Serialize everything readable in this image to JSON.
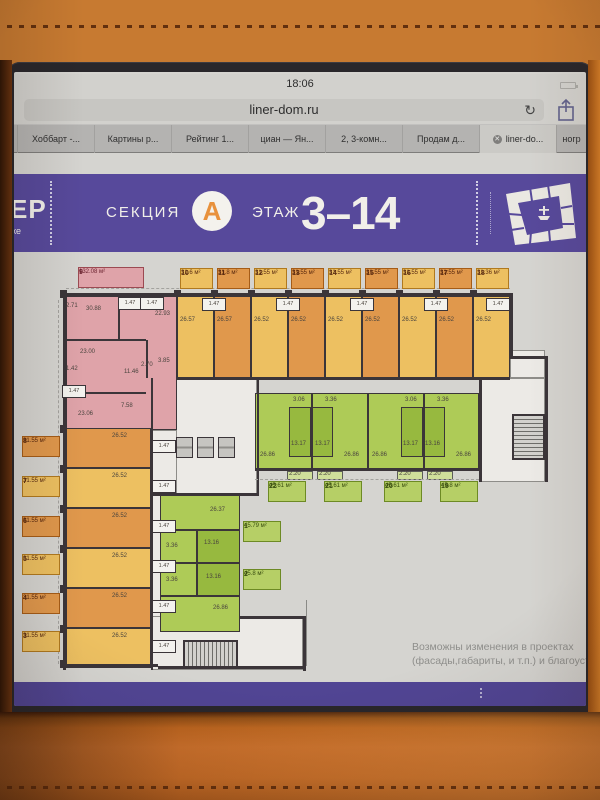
{
  "colors": {
    "screen_bg": "#d5d4d0",
    "bar_bg": "#d2d1cd",
    "field_bg": "#c7c6c2",
    "tabbar_bg": "#b4b3b1",
    "tab_active_bg": "#cbcac6",
    "purple": "#57499b",
    "purple_footer": "#514594",
    "accent_orange": "#e8913c",
    "plan_white": "#eceae6",
    "pink": "#dfa3a9",
    "yellow": "#edc061",
    "orange": "#e0984c",
    "green_light": "#aecb57",
    "green_dark": "#97b93f",
    "wall": "#3b3539"
  },
  "status_bar": {
    "time": "18:06"
  },
  "browser": {
    "url": "liner-dom.ru",
    "tabs": [
      "Хоббарт -...",
      "Картины р...",
      "Рейтинг 1...",
      "циан — Ян...",
      "2, 3-комн...",
      "Продам д...",
      "liner-do...",
      "ногр"
    ],
    "active_tab_index": 6
  },
  "header": {
    "logo_top": "ЕР",
    "logo_bottom": "ке",
    "section_label": "СЕКЦИЯ",
    "section_letter": "А",
    "floor_label": "ЭТАЖ",
    "floor_range": "3–14"
  },
  "plan": {
    "top_units": [
      {
        "id": "9",
        "area": "132.08 м²",
        "tone": "pink"
      },
      {
        "id": "10",
        "area": "31.6 м²",
        "tone": "yellow"
      },
      {
        "id": "11",
        "area": "31.8 м²",
        "tone": "orange"
      },
      {
        "id": "12",
        "area": "31.55 м²",
        "tone": "yellow"
      },
      {
        "id": "13",
        "area": "31.55 м²",
        "tone": "orange"
      },
      {
        "id": "14",
        "area": "31.55 м²",
        "tone": "yellow"
      },
      {
        "id": "15",
        "area": "31.55 м²",
        "tone": "orange"
      },
      {
        "id": "16",
        "area": "31.55 м²",
        "tone": "yellow"
      },
      {
        "id": "17",
        "area": "31.55 м²",
        "tone": "orange"
      },
      {
        "id": "18",
        "area": "31.36 м²",
        "tone": "yellow"
      }
    ],
    "left_units": [
      {
        "id": "8",
        "area": "31.55 м²",
        "tone": "orange"
      },
      {
        "id": "7",
        "area": "31.55 м²",
        "tone": "yellow"
      },
      {
        "id": "6",
        "area": "31.55 м²",
        "tone": "orange"
      },
      {
        "id": "5",
        "area": "31.55 м²",
        "tone": "yellow"
      },
      {
        "id": "4",
        "area": "31.55 м²",
        "tone": "orange"
      },
      {
        "id": "3",
        "area": "31.55 м²",
        "tone": "yellow"
      }
    ],
    "mid_units": [
      {
        "id": "22",
        "area": "45.61 м²",
        "tone": "green"
      },
      {
        "id": "21",
        "area": "45.61 м²",
        "tone": "green"
      },
      {
        "id": "20",
        "area": "45.61 м²",
        "tone": "green"
      },
      {
        "id": "19",
        "area": "45.8 м²",
        "tone": "green"
      }
    ],
    "low_units": [
      {
        "id": "1",
        "area": "45.79 м²",
        "tone": "green"
      },
      {
        "id": "2",
        "area": "45.8 м²",
        "tone": "green"
      }
    ],
    "room_values": [
      "30.88",
      "22.93",
      "23.00",
      "11.46",
      "23.06",
      "7.58",
      "2.71",
      "1.42",
      "2.70",
      "3.85",
      "26.57",
      "26.57",
      "26.52",
      "26.52",
      "26.52",
      "26.52",
      "26.52",
      "26.52",
      "26.52",
      "26.52",
      "26.52",
      "26.52",
      "26.52",
      "26.52",
      "26.52",
      "26.86",
      "13.17",
      "13.17",
      "26.86",
      "26.86",
      "13.17",
      "13.16",
      "26.86",
      "3.06",
      "3.36",
      "3.06",
      "3.36",
      "2.20",
      "2.20",
      "2.20",
      "2.20",
      "26.37",
      "13.16",
      "3.36",
      "13.16",
      "3.36",
      "26.86"
    ],
    "small_room_value": "1.47",
    "disclaimer_line1": "Возможны изменения в проектах",
    "disclaimer_line2": "(фасады,габариты, и т.п.) и благоуст"
  }
}
